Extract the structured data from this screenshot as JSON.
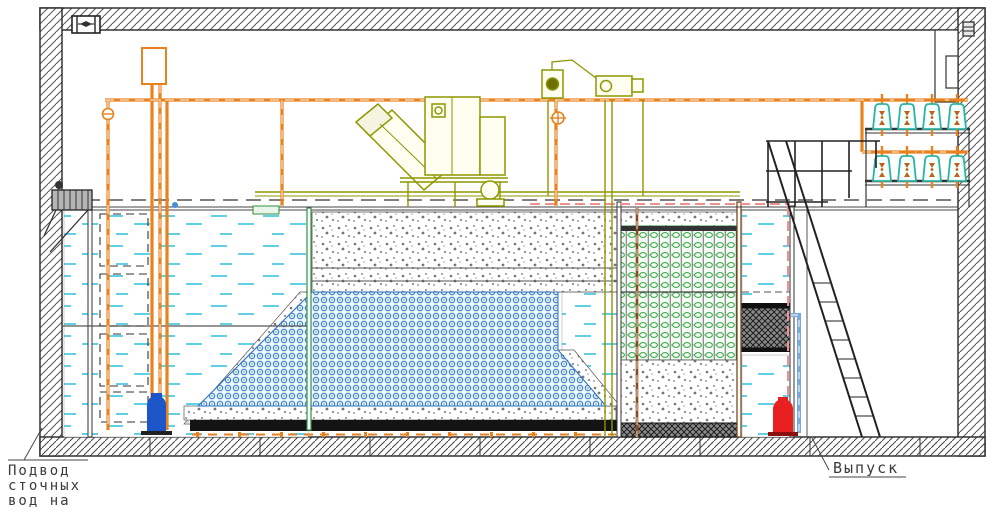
{
  "drawing": {
    "title_hint": "wastewater-treatment-plant-cross-section",
    "labels": {
      "inlet_line1": "Подвод",
      "inlet_line2": "сточных",
      "inlet_line3": "вод на",
      "inlet_line4": "очистку",
      "outlet": "Выпуск"
    },
    "colors": {
      "pipe_orange": "#e8821e",
      "pipe_brown": "#8a4a1a",
      "pipe_blue": "#7aa8d8",
      "equipment_olive": "#8f9700",
      "water_cyan": "#45c8e0",
      "media_blue": "#2b78c8",
      "media_green": "#3aa84a",
      "blower_teal": "#2fb3a3",
      "pump_red": "#e82020",
      "pump_blue": "#1d56c8",
      "marker_pink": "#f09090",
      "line_dark": "#333333"
    }
  }
}
